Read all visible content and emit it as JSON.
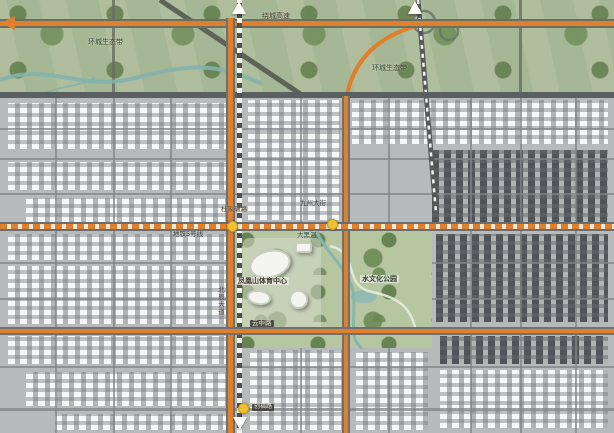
{
  "map": {
    "region_labels": {
      "ring_expressway": "绕城高速",
      "eco_belt_left": "环城生态带",
      "eco_belt_right": "环城生态带",
      "sports_center": "凤凰山体育中心",
      "culture_park": "水文化公园",
      "river": "大黑河"
    },
    "road_labels": {
      "dujianian_road": "杜家碾路",
      "metro_line5": "地铁5号线",
      "jiuzhou_street": "九州大街",
      "beichen_avenue": "北辰大道",
      "yunzhong_road": "云中路",
      "chuangfu_road": "创福路"
    },
    "colors": {
      "main_road_orange": "#e07f2c",
      "junction_marker_yellow": "#f2c12e",
      "eco_belt_green": "#a6b795",
      "park_green": "#b5c6a1",
      "river_teal": "#86b5ae",
      "city_gray": "#b7babb",
      "dark_road_gray": "#5a5f62"
    }
  }
}
